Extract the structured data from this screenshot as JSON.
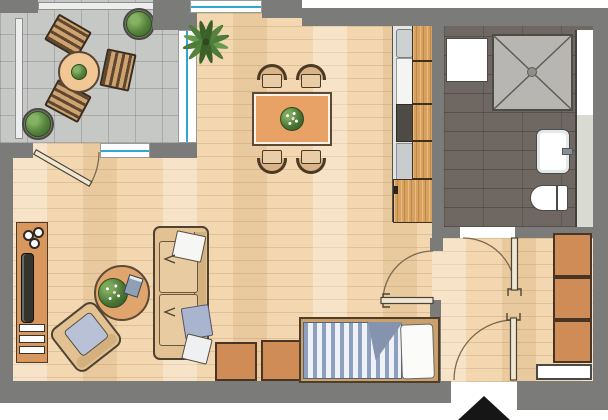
{
  "meta": {
    "type": "apartment-floor-plan",
    "canvas_w": 608,
    "canvas_h": 420,
    "text_labels": []
  },
  "colors": {
    "wall": "#7b7b79",
    "wood": "#f2d7b0",
    "tile": "#c6c8c6",
    "bath": "#6f6862",
    "glass": "#2fa8d5",
    "counter": "#d9a15e",
    "furn_wood": "#d9975e",
    "table_orange": "#e8a266",
    "upholstery": "#e2c193",
    "pillow_blue": "#a9b4cf",
    "duvet_blue": "#8ea1c1",
    "shower": "#b8b6b2",
    "arrow": "#161616"
  },
  "rooms": [
    {
      "id": "balcony",
      "floor": "concrete-tile",
      "contents": [
        "round-table-with-plant",
        "deck-chair",
        "deck-chair",
        "deck-chair",
        "potted-plant",
        "potted-plant",
        "railing"
      ]
    },
    {
      "id": "living-dining",
      "floor": "wood-parquet",
      "contents": [
        "palm-plant",
        "dining-table",
        "four-dining-chairs",
        "sofa",
        "armchair",
        "coffee-table-with-plant-and-book",
        "sideboard-with-tv-and-hifi",
        "bed",
        "chest",
        "chest"
      ]
    },
    {
      "id": "kitchen",
      "floor": "wood-parquet",
      "contents": [
        "counter-cabinets",
        "sink",
        "cooktop",
        "appliance"
      ]
    },
    {
      "id": "bathroom",
      "floor": "dark-tile",
      "contents": [
        "shower",
        "washing-machine",
        "washbasin",
        "toilet",
        "niche"
      ]
    },
    {
      "id": "hall",
      "floor": "wood-parquet",
      "contents": [
        "wardrobe-three-sections",
        "doormat"
      ]
    }
  ],
  "openings": {
    "doors": [
      "balcony-door",
      "living-to-hall-door",
      "bathroom-door",
      "entrance-door"
    ],
    "windows": [
      "north-window",
      "balcony-side-window",
      "balcony-wall-window"
    ],
    "entrance_marker": "black-triangle-arrow"
  }
}
